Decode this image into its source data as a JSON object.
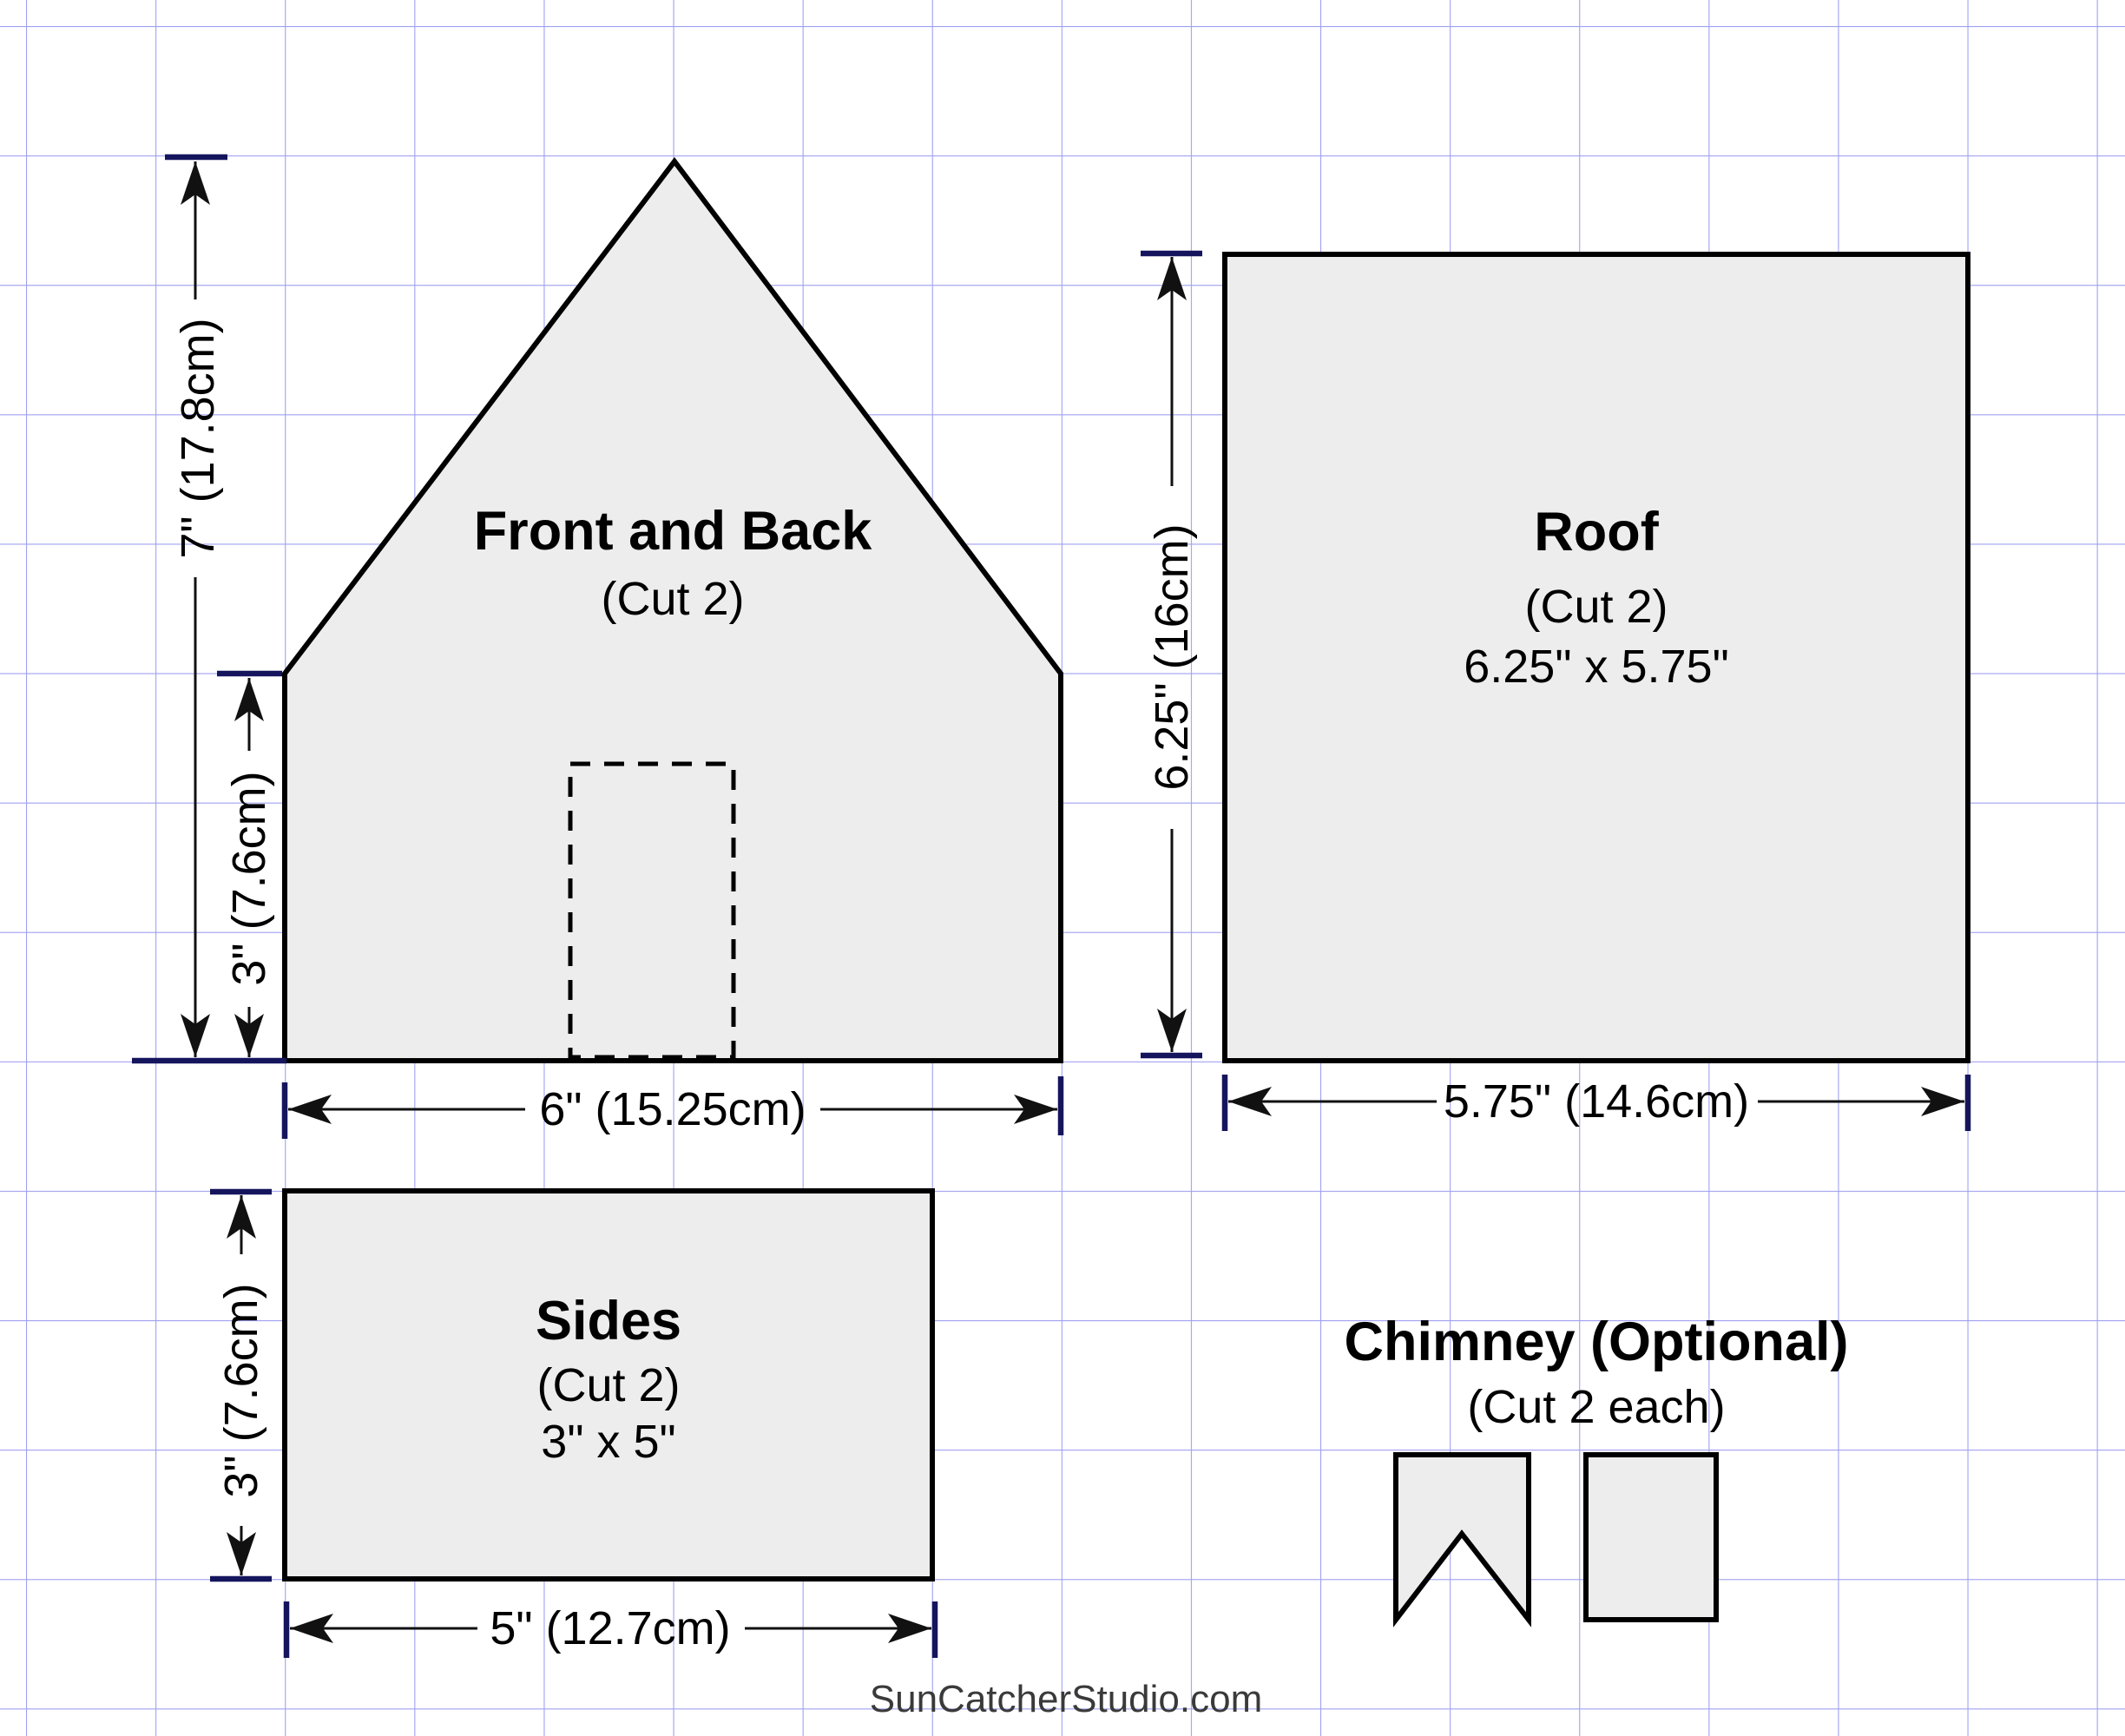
{
  "colors": {
    "grid": "#a0a0f2",
    "piece-fill": "#ededed",
    "piece-stroke": "#000000",
    "dim": "#111111",
    "tick": "#15155e",
    "wm": "#3a3a3a",
    "bg": "#ffffff"
  },
  "pieces": {
    "front_back": {
      "title": "Front and Back",
      "subtitle": "(Cut 2)"
    },
    "roof": {
      "title": "Roof",
      "subtitle": "(Cut 2)",
      "size": "6.25\" x 5.75\""
    },
    "sides": {
      "title": "Sides",
      "subtitle": "(Cut 2)",
      "size": "3\" x 5\""
    },
    "chimney": {
      "title": "Chimney (Optional)",
      "subtitle": "(Cut 2 each)"
    }
  },
  "dimensions": {
    "front_back_height": "7\" (17.8cm)",
    "front_back_wall": "3\" (7.6cm)",
    "front_back_width": "6\" (15.25cm)",
    "roof_height": "6.25\" (16cm)",
    "roof_width": "5.75\" (14.6cm)",
    "sides_height": "3\" (7.6cm)",
    "sides_width": "5\" (12.7cm)"
  },
  "watermark": "SunCatcherStudio.com"
}
